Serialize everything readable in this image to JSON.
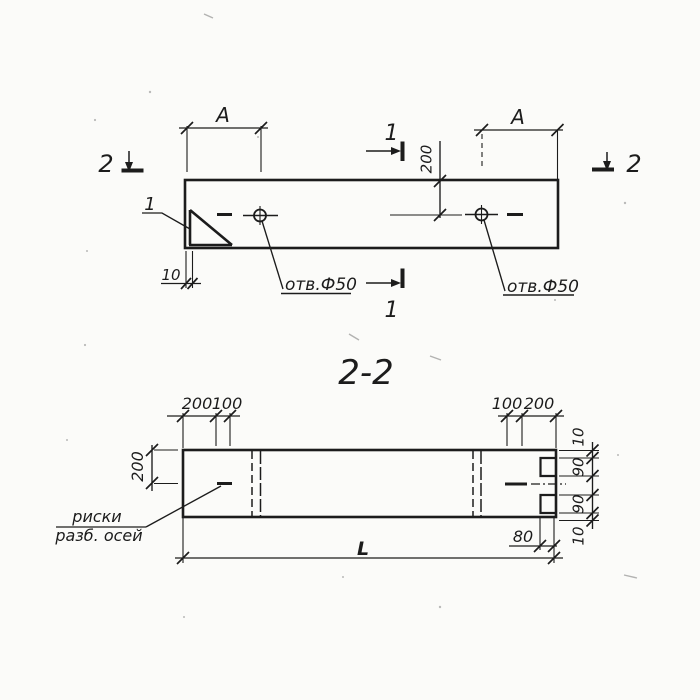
{
  "top_view": {
    "section_marker_left": "2",
    "section_marker_right": "2",
    "section_marker_top": "1",
    "section_marker_bottom": "1",
    "detail_callout": "1",
    "dim_a_left": "A",
    "dim_a_right": "A",
    "dim_depth": "200",
    "dim_edge": "10",
    "hole_label_left": "отв.Ф50",
    "hole_label_right": "отв.Ф50"
  },
  "section_view": {
    "title": "2-2",
    "dims_top_left": [
      "200",
      "100"
    ],
    "dims_top_right": [
      "100",
      "200"
    ],
    "dim_left": "200",
    "dims_right": [
      "10",
      "90",
      "90",
      "10"
    ],
    "dim_notch": "80",
    "dim_length": "L",
    "axis_label_line1": "риски",
    "axis_label_line2": "разб. осей"
  },
  "colors": {
    "ink": "#1c1c1c",
    "paper": "#fbfbf9"
  }
}
